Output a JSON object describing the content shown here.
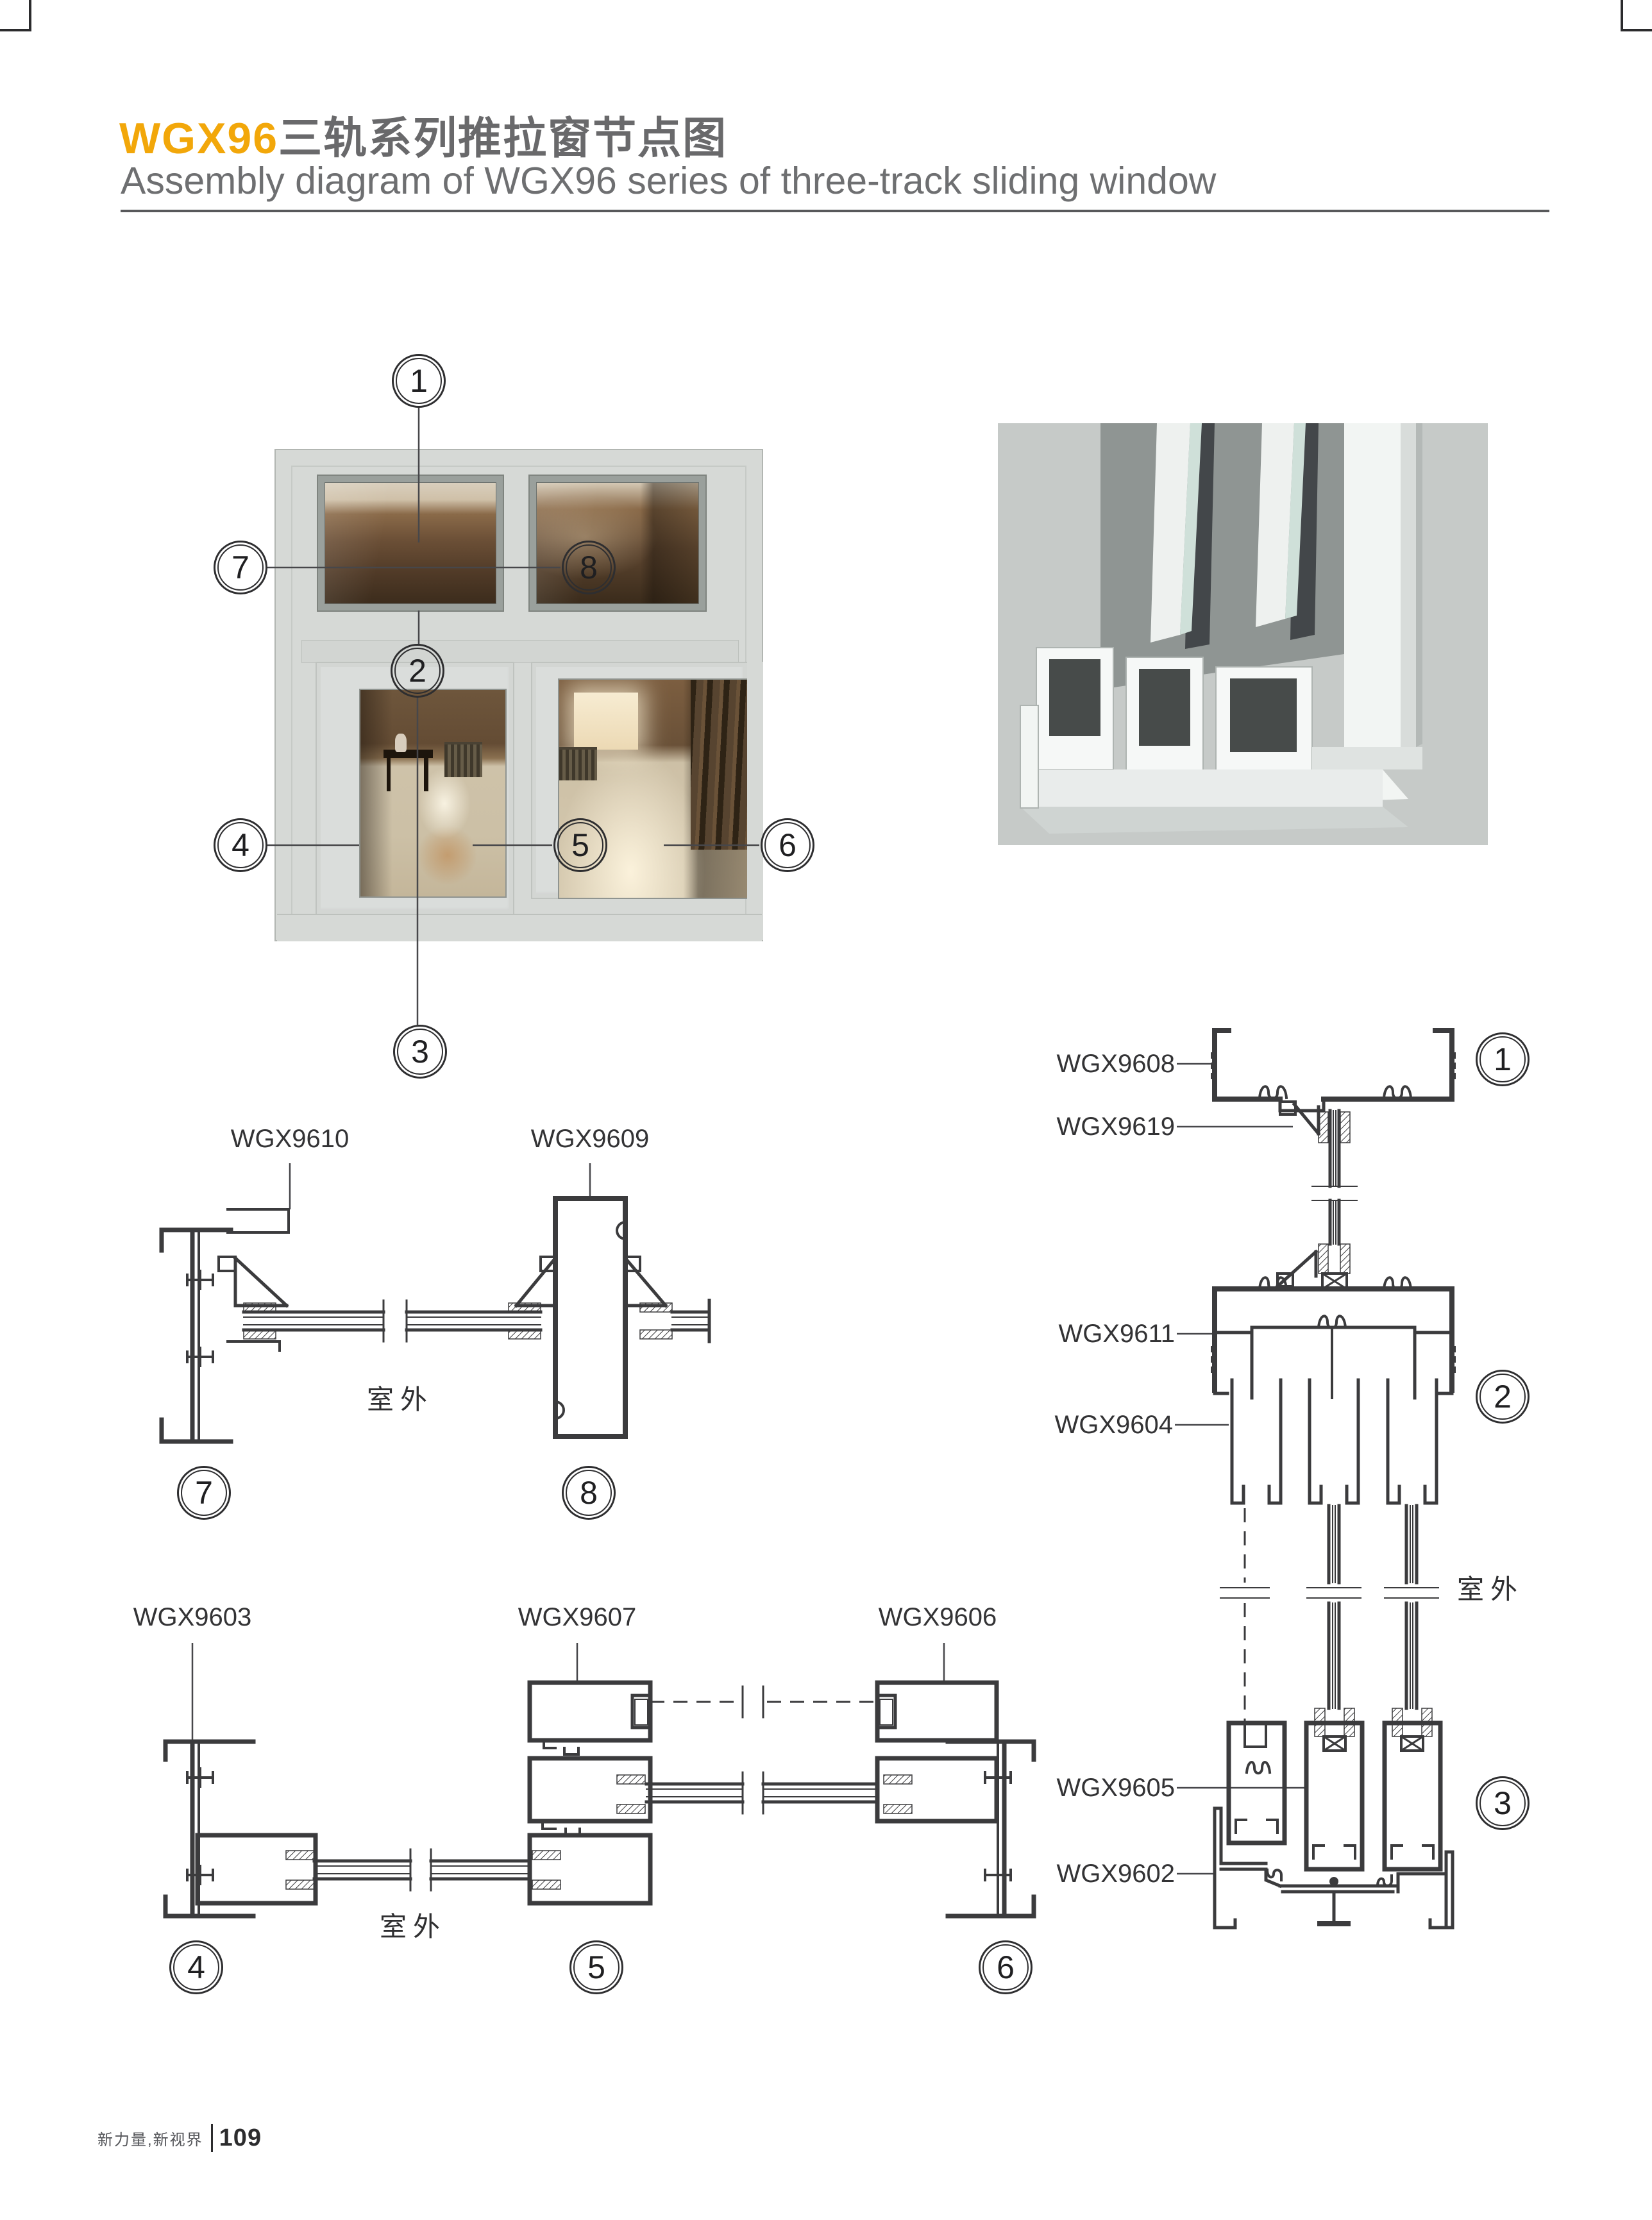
{
  "header": {
    "title_zh_brand": "WGX96",
    "title_zh_rest": "三轨系列推拉窗节点图",
    "title_en": "Assembly diagram of WGX96 series of three-track sliding window"
  },
  "callouts": {
    "c1": "1",
    "c2": "2",
    "c3": "3",
    "c4": "4",
    "c5": "5",
    "c6": "6",
    "c7": "7",
    "c8": "8"
  },
  "part_labels": {
    "wgx9610": "WGX9610",
    "wgx9609": "WGX9609",
    "wgx9603": "WGX9603",
    "wgx9607": "WGX9607",
    "wgx9606": "WGX9606",
    "wgx9608": "WGX9608",
    "wgx9619": "WGX9619",
    "wgx9611": "WGX9611",
    "wgx9604": "WGX9604",
    "wgx9605": "WGX9605",
    "wgx9602": "WGX9602"
  },
  "annotations": {
    "outdoor": "室外"
  },
  "footer": {
    "slogan": "新力量,新视界",
    "page_number": "109"
  },
  "colors": {
    "accent_yellow": "#F2A70A",
    "title_gray": "#69696B",
    "drawing_line": "#3B3B3D",
    "render_background": "#C6CAC8"
  }
}
